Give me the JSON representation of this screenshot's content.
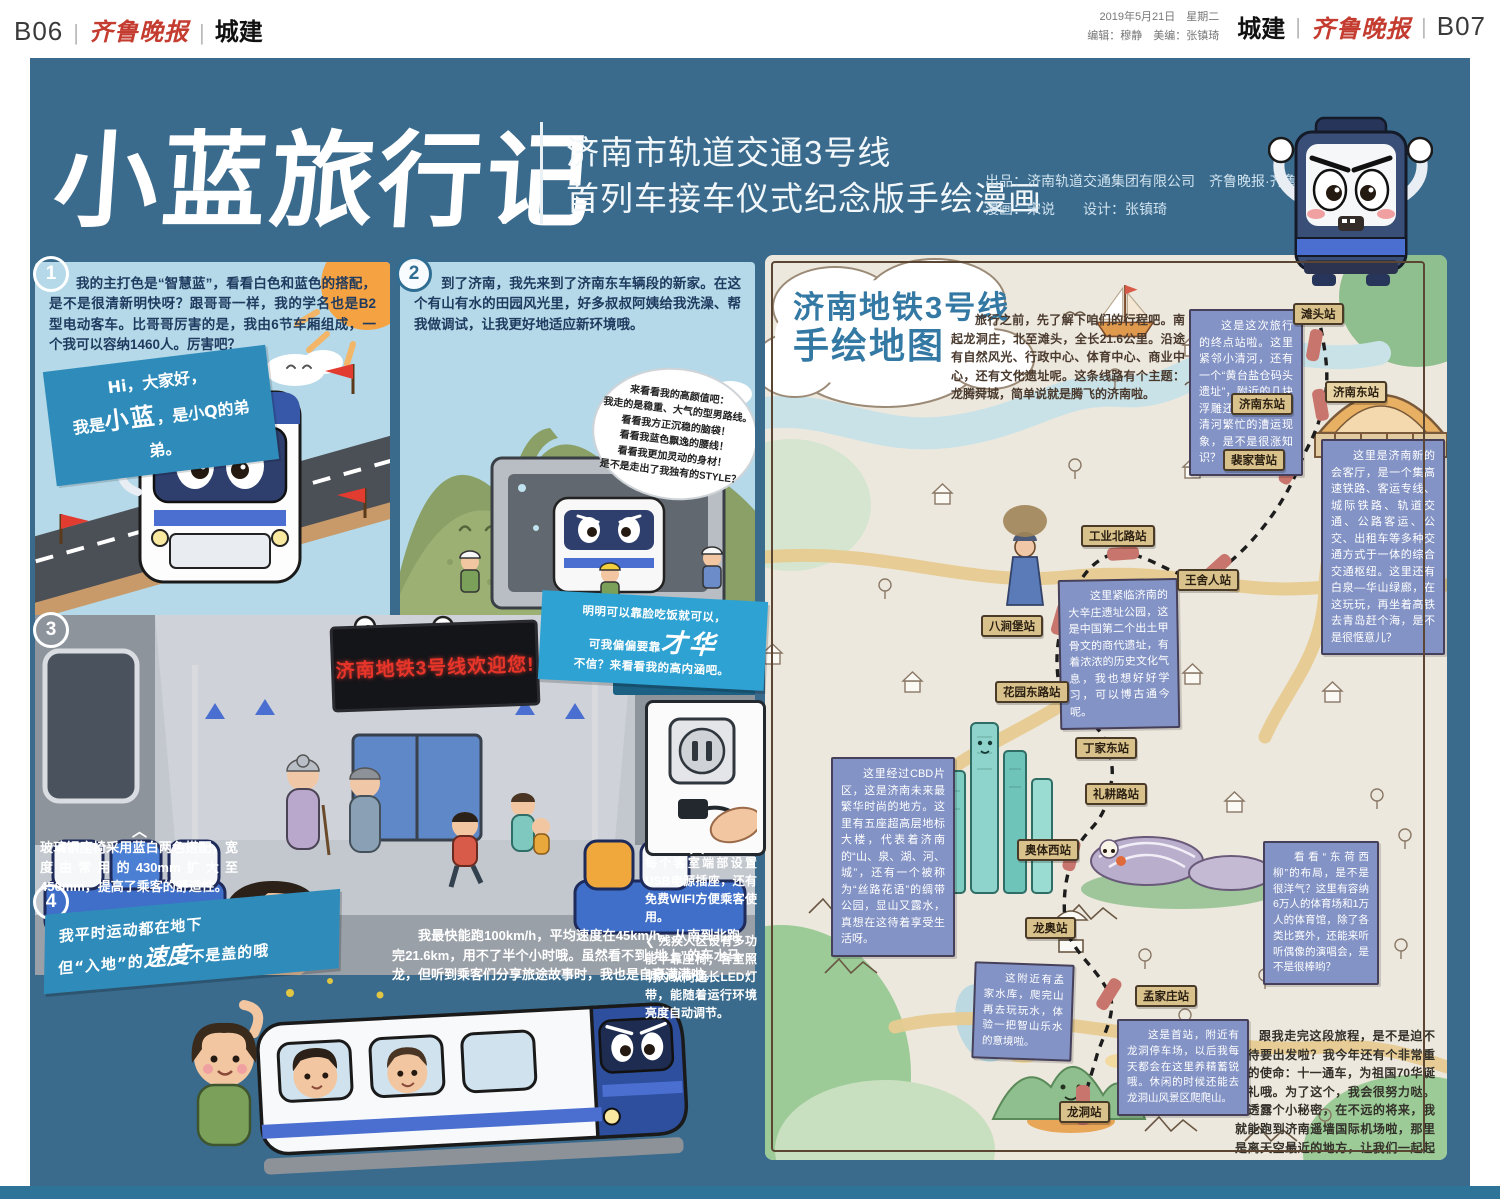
{
  "page": {
    "left_pageno": "B06",
    "right_pageno": "B07",
    "masthead": "齐鲁晚报",
    "section": "城建",
    "date_line": "2019年5月21日　星期二",
    "editor_line": "编辑：穆静　美编：张镇琦"
  },
  "title": {
    "main": "小蓝旅行记",
    "sub1": "济南市轨道交通3号线",
    "sub2": "首列车接车仪式纪念版手绘漫画",
    "credit1": "出品：济南轨道交通集团有限公司　齐鲁晚报·齐鲁壹点",
    "credit2": "漫画：宋说　　设计：张镇琦"
  },
  "icons": {
    "chevron_up": "︿",
    "chevron_left": "❮",
    "chevron_right": "❯"
  },
  "comic": {
    "panel1": {
      "num": "1",
      "narration": "我的主打色是“智慧蓝”，看看白色和蓝色的搭配，是不是很清新明快呀？跟哥哥一样，我的学名也是B2型电动客车。比哥哥厉害的是，我由6节车厢组成，一个我可以容纳1460人。厉害吧？",
      "bubble_l1": "Hi，大家好，",
      "bubble_l2a": "我是",
      "bubble_name": "小蓝",
      "bubble_l2b": "，是小Q的弟弟。"
    },
    "panel2": {
      "num": "2",
      "narration": "到了济南，我先来到了济南东车辆段的新家。在这个有山有水的田园风光里，好多叔叔阿姨给我洗澡、帮我做调试，让我更好地适应新环境哦。",
      "bubble_lines": [
        "来看看我的高颜值吧：",
        "我走的是稳重、大气的型男路线。",
        "看看我方正沉稳的脑袋！",
        "看看我蓝色飘逸的腰线！",
        "看看我更加灵动的身材！",
        "是不是走出了我独有的STYLE？"
      ]
    },
    "panel3": {
      "num": "3",
      "caption": "客室提醒字幕加宽了，字加大了，更加人性化了。",
      "led_text": "济南地铁3号线欢迎您!",
      "talent_l1": "明明可以靠脸吃饭就可以，",
      "talent_l2a": "可我偏偏要靠",
      "talent_em": "才华",
      "talent_l3": "不信？来看看我的高内涵吧。",
      "seat_note": "玻璃钢座椅采用蓝白两色搭配，宽度由常用的430mm扩大至450mm，提高了乘客的舒适性。",
      "usb_note": "每个客室端部设置USB电源插座，还有免费WIFI方便乘客使用。",
      "led_note": "残疾人区设有多功能半靠座椅；客室照明为纵向通长LED灯带，能随着运行环境亮度自动调节。"
    },
    "panel4": {
      "num": "4",
      "slogan_l1": "我平时运动都在地下",
      "slogan_l2a": "但“入地”的",
      "slogan_em": "速度",
      "slogan_l2b": "不是盖的哦",
      "narration": "我最快能跑100km/h，平均速度在45km/h，从南到北跑完21.6km，用不了半个小时哦。虽然看不到“地上”的车水马龙，但听到乘客们分享旅途故事时，我也是自豪满满啦。"
    }
  },
  "map": {
    "title_l1": "济南地铁3号线",
    "title_l2": "手绘地图",
    "intro": "旅行之前，先了解下咱们的行程吧。南起龙洞庄，北至滩头，全长21.6公里。沿途有自然风光、行政中心、体育中心、商业中心，还有文化遗址呢。这条线路有个主题：龙腾舜城，简单说就是腾飞的济南啦。",
    "stations": [
      "滩头站",
      "济南东站",
      "裴家营站",
      "工业北路站",
      "王舍人站",
      "八涧堡站",
      "花园东路站",
      "丁家东站",
      "礼耕路站",
      "奥体西站",
      "龙奥站",
      "孟家庄站",
      "龙洞站"
    ],
    "station_building_label": "济南东站",
    "notes": [
      "这是这次旅行的终点站啦。这里紧邻小清河，还有一个“黄台盐仓码头遗址”，附近的几块浮雕还原了当年小清河繁忙的漕运现象，是不是很涨知识？",
      "这里是济南新的会客厅，是一个集高速铁路、客运专线、城际铁路、轨道交通、公路客运、公交、出租车等多种交通方式于一体的综合交通枢纽。这里还有白泉—华山绿廊，在这玩玩，再坐着高铁去青岛赶个海，是不是很惬意儿？",
      "这里紧临济南的大辛庄遗址公园，这是中国第二个出土甲骨文的商代遗址，有着浓浓的历史文化气息，我也想好好学习，可以博古通今呢。",
      "这里经过CBD片区，这是济南未来最繁华时尚的地方。这里有五座超高层地标大楼，代表着济南的“山、泉、湖、河、城”，还有一个被称为“丝路花语”的绸带公园，显山又露水，真想在这待着享受生活呀。",
      "看看“东荷西柳”的布局，是不是很洋气？这里有容纳6万人的体育场和1万人的体育馆，除了各类比赛外，还能来听听偶像的演唱会，是不是很棒哟？",
      "这附近有孟家水库，爬完山再去玩玩水，体验一把智山乐水的意境啦。",
      "这是首站，附近有龙洞停车场，以后我每天都会在这里养精蓄锐哦。休闲的时候还能去龙洞山风景区爬爬山。"
    ],
    "outro": "跟我走完这段旅程，是不是迫不及待要出发啦？我今年还有个非常重要的使命：十一通车，为祖国70华诞献礼哦。为了这个，我会很努力哒。再透露个小秘密，在不远的将来，我就能跑到济南遥墙国际机场啦，那里是离天空最近的地方，让我们一起起飞吧！"
  },
  "colors": {
    "board_blue": "#3a6b8d",
    "sky_blue": "#b5d9e8",
    "map_cream": "#ede8dd",
    "note_blue": "#8393c5",
    "station_tan": "#d9c18c",
    "route_pink": "#c8766d",
    "led_red": "#e8352a",
    "map_title_blue": "#3379a4",
    "logo_red": "#c43b2f",
    "bubble_blue": "#2f8cba",
    "talent_blue": "#2ea2d2"
  }
}
